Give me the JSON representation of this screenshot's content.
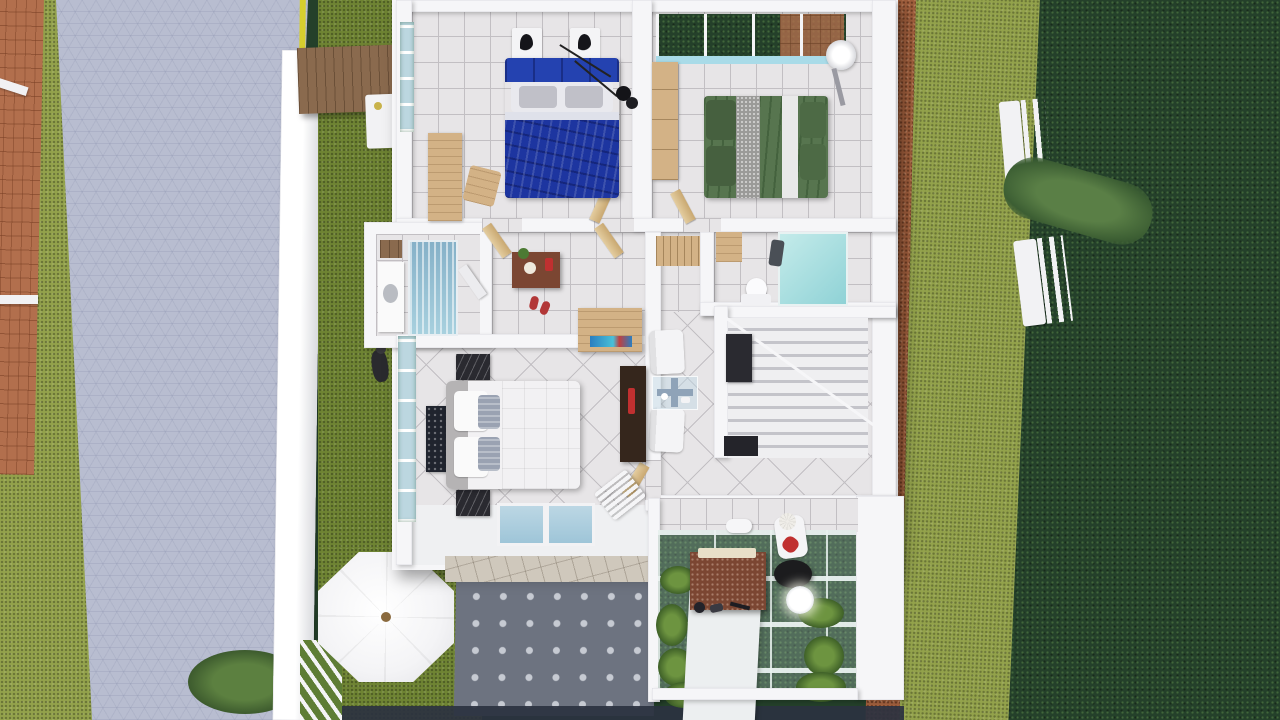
{
  "scene": {
    "title": "Top-down 3D architectural render of a small house floor plan",
    "view": "top-down",
    "rooms": [
      "bedroom-blue",
      "bedroom-green",
      "bathroom-left",
      "hallway",
      "bathroom-right",
      "living-area",
      "staircase",
      "master-bedroom",
      "entry-porch",
      "terrace-pergola"
    ],
    "outdoor_features": [
      "hex-paved-driveway",
      "yellow-curb-line",
      "boundary-wall",
      "wood-gate-canopy",
      "washing-machine",
      "lawn-strips",
      "octagon-patio-umbrella",
      "dotted-paved-patio",
      "garden-benches",
      "hedge-row",
      "brown-gravel-path",
      "planted-terrace",
      "white-walkway",
      "stone-entry-steps",
      "garden-bush",
      "brick-carport-roof"
    ],
    "furniture": [
      "blue-double-bed",
      "green-double-bed",
      "white-double-bed",
      "desk-and-chair",
      "wardrobe",
      "bedside-lamps",
      "ceiling-pendant",
      "shower-enclosure-blue",
      "shower-enclosure-aqua",
      "toilet",
      "vanity",
      "hall-sideboard",
      "slippers",
      "armchairs",
      "glass-coffee-table",
      "tv-panel",
      "aquarium-cabinet",
      "nightstands",
      "floor-rug-art",
      "slatted-bench",
      "terrace-desk",
      "floor-lamp",
      "lounge-chair-red-pillow"
    ]
  },
  "colors": {
    "wall": "#f6f6f8",
    "tile": "#e7e5e7",
    "tileLine": "#c2bfc3",
    "paveGray": "#b8bdd0",
    "grassDark": "#24402a",
    "grassMid": "#6f8433",
    "grassLight": "#93a24b",
    "brick": "#b26f4d",
    "brownPath": "#a15f3d",
    "wood": "#d3b286",
    "woodDark": "#8a6a4e",
    "stone": "#cfc8bc",
    "blueBed": "#1d35a0",
    "greenBed": "#57754f",
    "whiteBed": "#f2f1f3",
    "patio": "#6d7380",
    "patioDot": "#c6cad2",
    "umbrella": "#f4f4f6",
    "walkway": "#eceff0",
    "lampBlack": "#1c1c1e",
    "redAccent": "#c03030",
    "yellowLine": "#d6cf2e",
    "darkBand": "#2b3240",
    "nightstandDark": "#2a2a30",
    "tvPanelDark": "#35261c",
    "sideboardBrown": "#7b4632"
  }
}
